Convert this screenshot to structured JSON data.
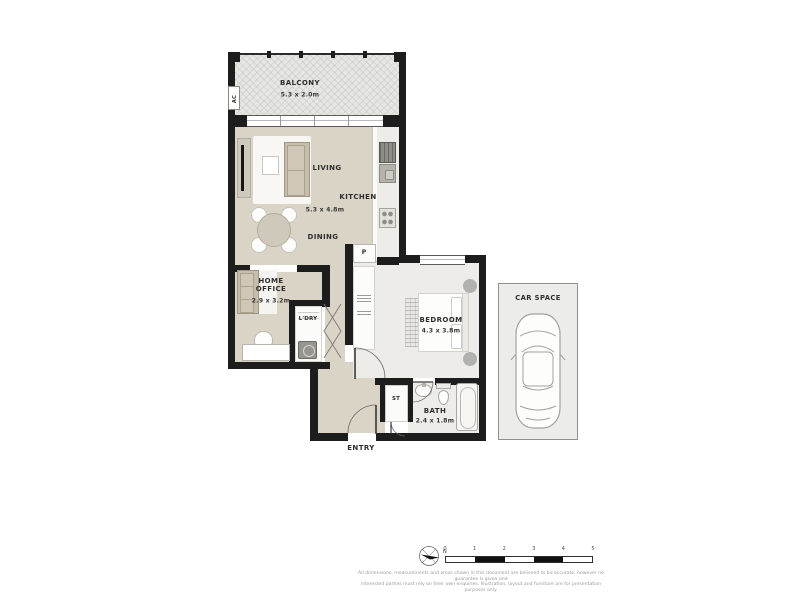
{
  "plan": {
    "rooms": {
      "balcony": {
        "name": "BALCONY",
        "dims": "5.3 x 2.0m"
      },
      "living": {
        "name": "LIVING"
      },
      "kitchen": {
        "name": "KITCHEN"
      },
      "living_dims": "5.3 x 4.8m",
      "dining": {
        "name": "DINING"
      },
      "home_office": {
        "name": "HOME OFFICE",
        "dims": "2.9 x 3.2m"
      },
      "laundry": {
        "name": "L'DRY"
      },
      "bedroom": {
        "name": "BEDROOM",
        "dims": "4.3 x 3.8m"
      },
      "bath": {
        "name": "BATH",
        "dims": "2.4 x 1.8m"
      },
      "storage": {
        "name": "ST"
      },
      "entry": {
        "name": "ENTRY"
      },
      "pantry": {
        "name": "P"
      },
      "ac_unit": {
        "name": "AC"
      },
      "car_space": {
        "name": "CAR SPACE"
      }
    }
  },
  "legend": {
    "compass_label": "N",
    "scale": {
      "labels": [
        "0",
        "1",
        "2",
        "3",
        "4",
        "5"
      ]
    },
    "disclaimer": [
      "All dimensions, measurements and areas shown in this document are believed to be accurate, however no guarantee is given and",
      "interested parties must rely on their own enquiries. Illustration, layout and furniture are for presentation purposes only."
    ]
  },
  "colors": {
    "wall": "#1d1d1d",
    "floor_main": "#d9d4c6",
    "floor_bedroom": "#edece8",
    "balcony": "#e6e6e3",
    "car_space_bg": "#ececea"
  }
}
